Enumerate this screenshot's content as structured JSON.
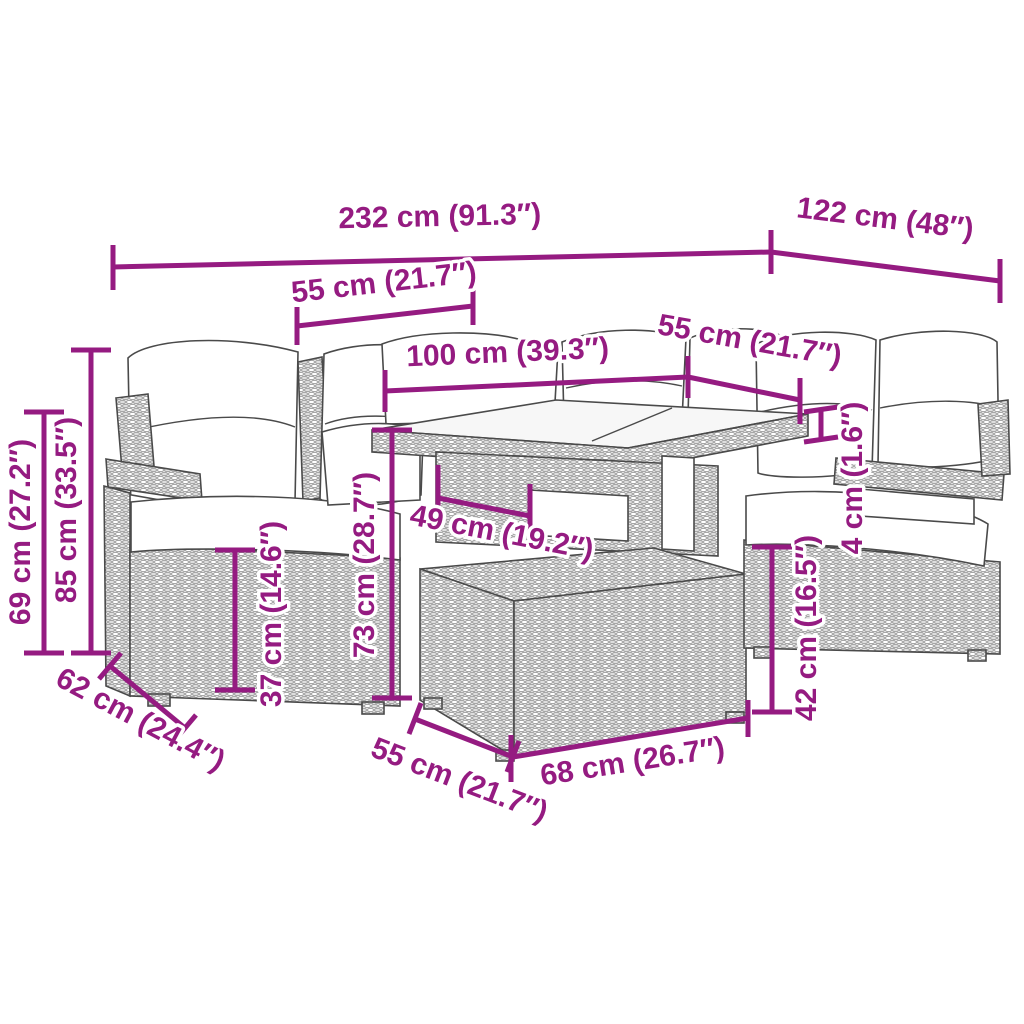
{
  "diagram": {
    "kind": "product-dimension-diagram",
    "subject": "poly rattan garden lounge set with table and ottoman",
    "accent_color": "#951B81",
    "sketch_color": "#4a4a4a",
    "background_color": "#ffffff"
  },
  "dims": [
    {
      "id": "overall-width",
      "label": "232 cm (91.3″)",
      "cm": 232,
      "inches": 91.3
    },
    {
      "id": "overall-depth",
      "label": "122 cm (48″)",
      "cm": 122,
      "inches": 48
    },
    {
      "id": "left-seat-width",
      "label": "55 cm (21.7″)",
      "cm": 55,
      "inches": 21.7
    },
    {
      "id": "table-length",
      "label": "100 cm (39.3″)",
      "cm": 100,
      "inches": 39.3
    },
    {
      "id": "right-seat-width",
      "label": "55 cm (21.7″)",
      "cm": 55,
      "inches": 21.7
    },
    {
      "id": "backrest-height",
      "label": "69 cm (27.2″)",
      "cm": 69,
      "inches": 27.2
    },
    {
      "id": "total-height",
      "label": "85 cm (33.5″)",
      "cm": 85,
      "inches": 33.5
    },
    {
      "id": "seat-height",
      "label": "37 cm (14.6″)",
      "cm": 37,
      "inches": 14.6
    },
    {
      "id": "table-height",
      "label": "73 cm (28.7″)",
      "cm": 73,
      "inches": 28.7
    },
    {
      "id": "table-shelf-depth",
      "label": "49 cm (19.2″)",
      "cm": 49,
      "inches": 19.2
    },
    {
      "id": "tabletop-thickness",
      "label": "4 cm (1.6″)",
      "cm": 4,
      "inches": 1.6
    },
    {
      "id": "ottoman-height",
      "label": "42 cm (16.5″)",
      "cm": 42,
      "inches": 16.5
    },
    {
      "id": "seat-depth",
      "label": "62 cm (24.4″)",
      "cm": 62,
      "inches": 24.4
    },
    {
      "id": "ottoman-depth",
      "label": "55 cm (21.7″)",
      "cm": 55,
      "inches": 21.7
    },
    {
      "id": "ottoman-width",
      "label": "68 cm (26.7″)",
      "cm": 68,
      "inches": 26.7
    }
  ]
}
